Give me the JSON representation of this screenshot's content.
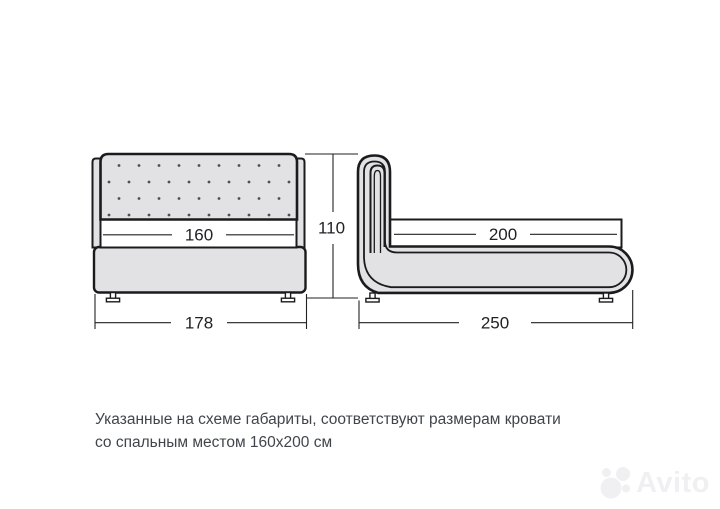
{
  "diagram": {
    "overall_height": "110",
    "front_view": {
      "mattress_width": "160",
      "overall_width": "178"
    },
    "side_view": {
      "mattress_length": "200",
      "overall_length": "250"
    }
  },
  "caption": {
    "line1": "Указанные на схеме габариты, соответствуют размерам кровати",
    "line2": "со спальным местом 160х200 см"
  },
  "watermark": {
    "brand": "Avito"
  },
  "colors": {
    "upholstery_fill": "#e2e2e4",
    "outline": "#1b1b1d",
    "dimension_line": "#222226",
    "caption_text": "#41454b",
    "watermark": "#f0f0f2"
  }
}
